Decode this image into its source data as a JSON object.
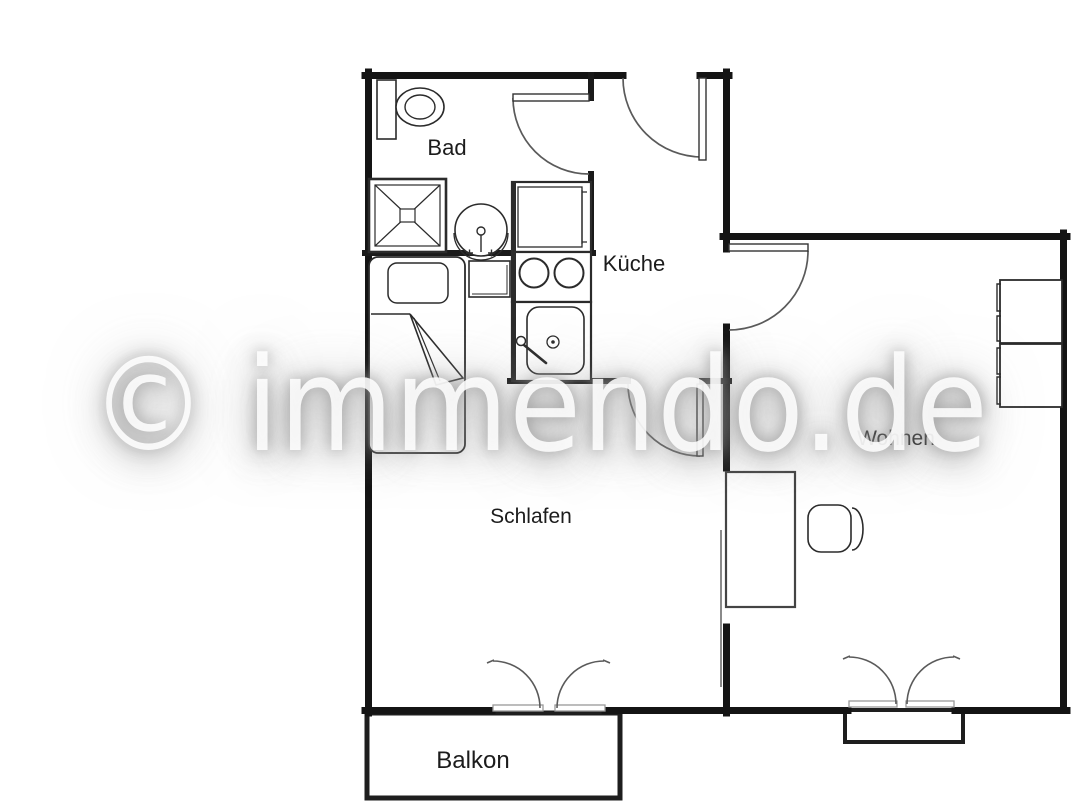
{
  "watermark": {
    "text": "© immendo.de"
  },
  "rooms": {
    "bad": {
      "label": "Bad"
    },
    "kueche": {
      "label": "Küche"
    },
    "schlafen": {
      "label": "Schlafen"
    },
    "wohnen": {
      "label": "Wohnen"
    },
    "balkon": {
      "label": "Balkon"
    }
  },
  "fixtures": {
    "bathroom": [
      "toilet",
      "shower",
      "washbasin"
    ],
    "kitchen": [
      "refrigerator",
      "stove",
      "sink"
    ],
    "bedroom": [
      "single-bed",
      "nightstand"
    ],
    "living_room": [
      "sofa",
      "desk",
      "office-chair"
    ],
    "doors": [
      "entrance-door",
      "bathroom-door",
      "bedroom-door",
      "living-room-door",
      "bedroom-balcony-double-door",
      "living-room-balcony-double-door"
    ]
  },
  "colors": {
    "background": "#ffffff",
    "wall": "#141414",
    "furniture_line": "#2b2b2b",
    "door_arc": "#5a5a5a",
    "watermark_text": "#ffffff",
    "watermark_glow": "#8c8c8c"
  }
}
